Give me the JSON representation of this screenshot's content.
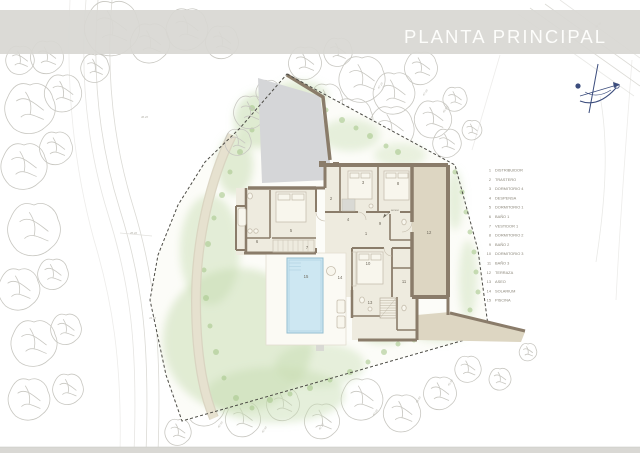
{
  "banner": {
    "title": "PLANTA PRINCIPAL",
    "bg_color": "#d8d7d3",
    "text_color": "#fdfdfb"
  },
  "legend": {
    "items": [
      {
        "num": "1",
        "label": "DISTRIBUIDOR"
      },
      {
        "num": "2",
        "label": "TRASTERO"
      },
      {
        "num": "3",
        "label": "DORMITORIO 4"
      },
      {
        "num": "4",
        "label": "DESPENSA"
      },
      {
        "num": "5",
        "label": "DORMITORIO 1"
      },
      {
        "num": "6",
        "label": "BAÑO 1"
      },
      {
        "num": "7",
        "label": "VESTIDOR 1"
      },
      {
        "num": "8",
        "label": "DORMITORIO 2"
      },
      {
        "num": "9",
        "label": "BAÑO 2"
      },
      {
        "num": "10",
        "label": "DORMITORIO 3"
      },
      {
        "num": "11",
        "label": "BAÑO 3"
      },
      {
        "num": "12",
        "label": "TERRAZA"
      },
      {
        "num": "13",
        "label": "ASEO"
      },
      {
        "num": "14",
        "label": "SOLARIUM"
      },
      {
        "num": "15",
        "label": "PISCINA"
      }
    ]
  },
  "annotations": {
    "entry": "acceso",
    "spot_labels": [
      {
        "t": "45.40"
      },
      {
        "t": "46.20"
      },
      {
        "t": "44.80"
      },
      {
        "t": "42.60"
      },
      {
        "t": "42.40"
      },
      {
        "t": "42.20"
      },
      {
        "t": "42.00"
      },
      {
        "t": "41.80"
      },
      {
        "t": "41.60"
      },
      {
        "t": "47.20"
      },
      {
        "t": "47.00"
      },
      {
        "t": "46.80"
      },
      {
        "t": "48.20"
      },
      {
        "t": "48.40"
      }
    ]
  },
  "colors": {
    "wall": "#8a7c6a",
    "floor": "#eeebdf",
    "terrace": "#ddd6c2",
    "roof_gray": "#d5d6d8",
    "pool_fill": "#cde7f2",
    "pool_edge": "#93bdd1",
    "deck": "#fbfaf4",
    "lawn_wash": "#c6dcb0",
    "boundary": "#4c4b45",
    "compass": "#3c4d7d"
  }
}
